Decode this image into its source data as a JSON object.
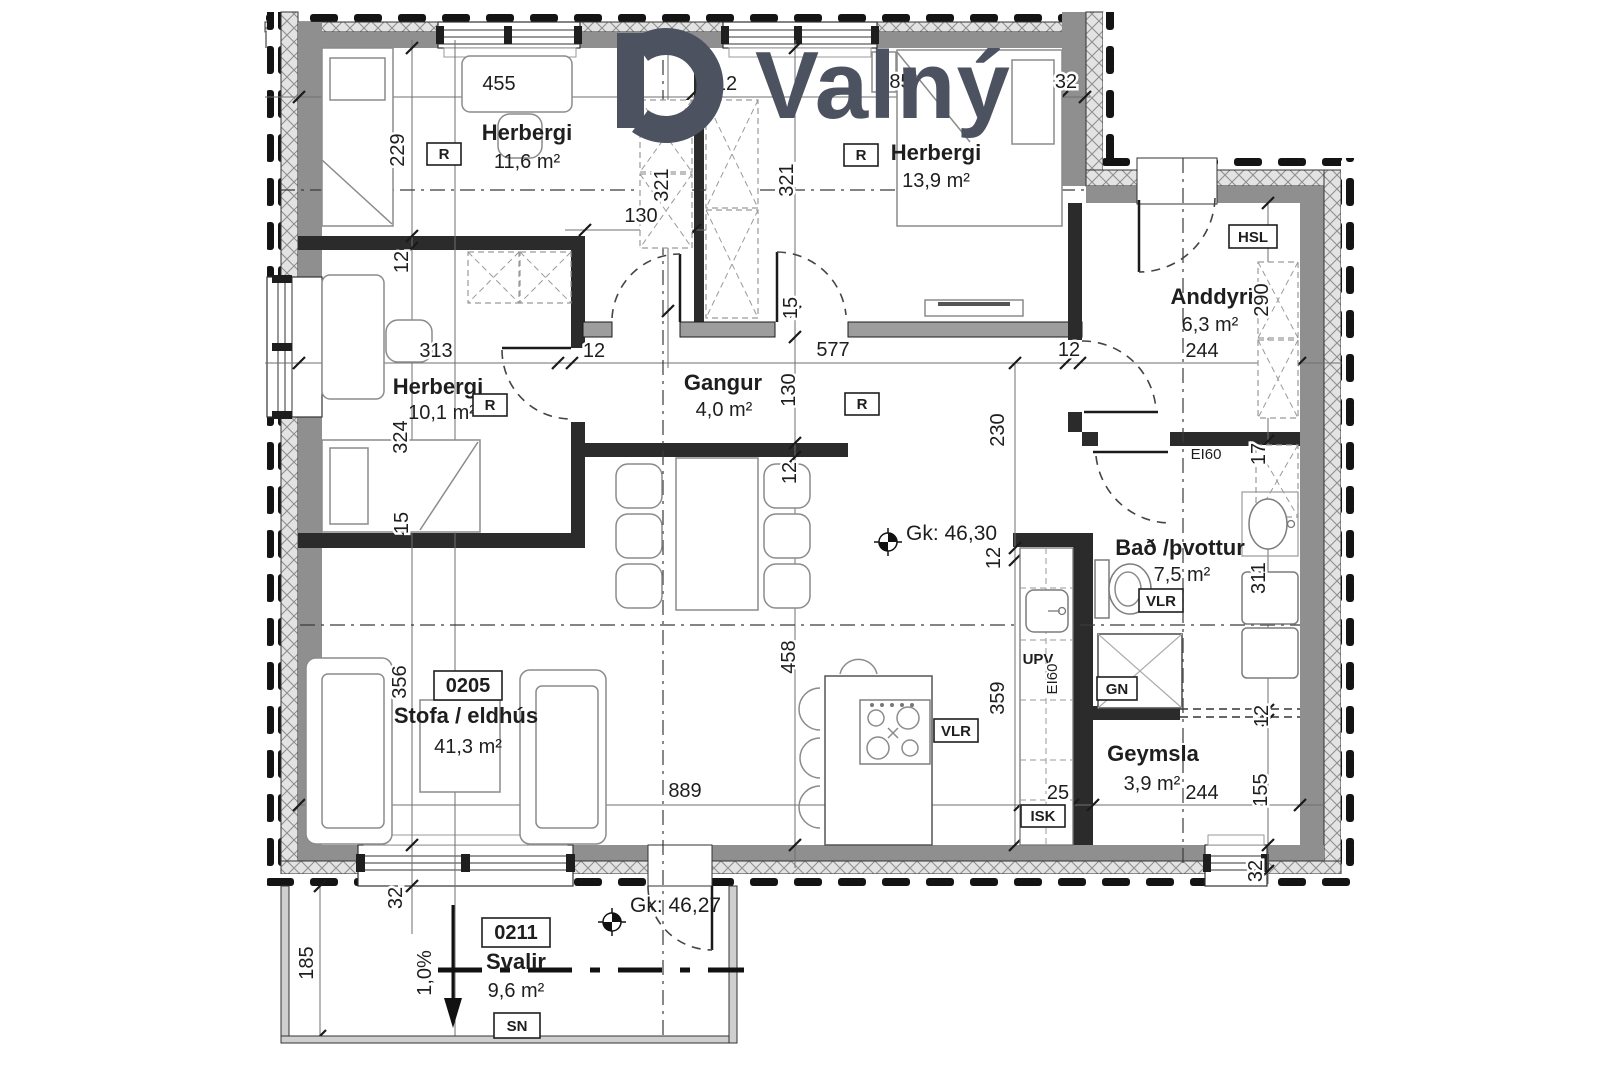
{
  "brand": {
    "wordmark": "Valný"
  },
  "rooms": {
    "h116": {
      "name": "Herbergi",
      "area": "11,6 m²"
    },
    "h139": {
      "name": "Herbergi",
      "area": "13,9 m²"
    },
    "h101": {
      "name": "Herbergi",
      "area": "10,1 m²"
    },
    "gangur": {
      "name": "Gangur",
      "area": "4,0 m²"
    },
    "anddyri": {
      "name": "Anddyri",
      "area": "6,3 m²"
    },
    "bad": {
      "name": "Bað /þvottur",
      "area": "7,5 m²"
    },
    "stofa": {
      "name": "Stofa / eldhús",
      "area": "41,3 m²"
    },
    "geymsla": {
      "name": "Geymsla",
      "area": "3,9 m²"
    },
    "svalir": {
      "name": "Svalir",
      "area": "9,6 m²"
    }
  },
  "codes": {
    "unit": "0205",
    "svalir_unit": "0211",
    "r": "R",
    "hsl": "HSL",
    "vlr": "VLR",
    "gn": "GN",
    "upv": "UPV",
    "isk": "ISK",
    "sn": "SN",
    "ei60": "EI60"
  },
  "levels": {
    "main": "Gk: 46,30",
    "balcony": "Gk: 46,27",
    "slope": "1,0%"
  },
  "dims": {
    "d455": "455",
    "d485": "485",
    "d313": "313",
    "d577": "577",
    "d130a": "130",
    "d130b": "130",
    "d889": "889",
    "d25": "25",
    "d244a": "244",
    "d244b": "244",
    "d229": "229",
    "d321a": "321",
    "d321b": "321",
    "d324": "324",
    "d356": "356",
    "d290": "290",
    "d230": "230",
    "d359": "359",
    "d458": "458",
    "d311": "311",
    "d155": "155",
    "d185": "185",
    "d15a": "15",
    "d15b": "15",
    "d17": "17",
    "d12a": "12",
    "d12b": "12",
    "d12c": "12",
    "d12d": "12",
    "d12e": "12",
    "d12f": "12",
    "d12g": "12",
    "d32a": "32",
    "d32b": "32",
    "d32c": "32"
  }
}
